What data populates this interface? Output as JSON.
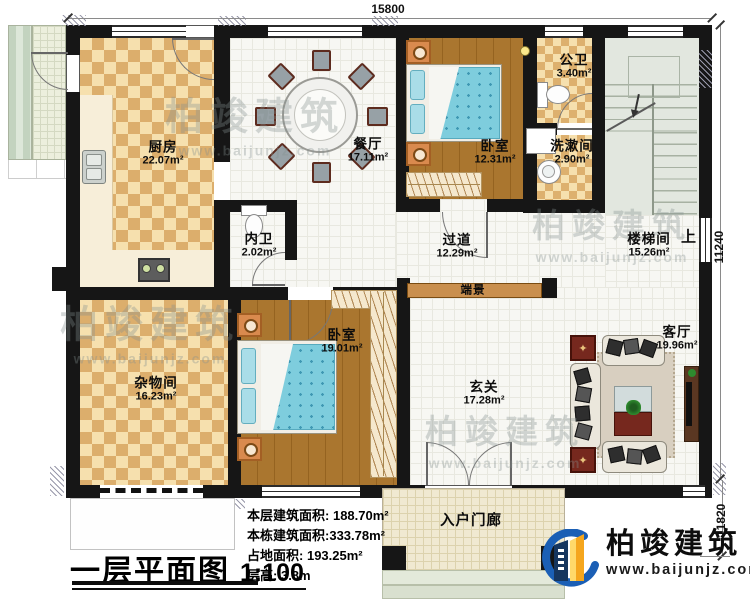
{
  "dimensions": {
    "top": "15800",
    "right_upper": "11240",
    "right_lower": "1820"
  },
  "rooms": {
    "kitchen": {
      "name": "厨房",
      "area": "22.07m²"
    },
    "dining": {
      "name": "餐厅",
      "area": "17.11m²"
    },
    "bedroom_top": {
      "name": "卧室",
      "area": "12.31m²"
    },
    "public_bath": {
      "name": "公卫",
      "area": "3.40m²"
    },
    "washroom": {
      "name": "洗漱间",
      "area": "2.90m²"
    },
    "stairwell": {
      "name": "楼梯间",
      "area": "15.26m²"
    },
    "corridor": {
      "name": "过道",
      "area": "12.29m²"
    },
    "inner_bath": {
      "name": "内卫",
      "area": "2.02m²"
    },
    "bedroom_bottom": {
      "name": "卧室",
      "area": "19.01m²"
    },
    "storage": {
      "name": "杂物间",
      "area": "16.23m²"
    },
    "foyer": {
      "name": "玄关",
      "area": "17.28m²"
    },
    "living": {
      "name": "客厅",
      "area": "19.96m²"
    }
  },
  "labels": {
    "up": "上",
    "console": "端景",
    "entry_porch": "入户门廊"
  },
  "stats": [
    {
      "label": "本层建筑面积:",
      "value": "188.70m²"
    },
    {
      "label": "本栋建筑面积:",
      "value": "333.78m²"
    },
    {
      "label": "占地面积:",
      "value": "193.25m²"
    },
    {
      "label": "层高:",
      "value": "3.8m"
    }
  ],
  "title": {
    "name": "一层平面图",
    "scale": "1:100"
  },
  "brand": {
    "name": "柏竣建筑",
    "url": "www.baijunjz.com"
  },
  "watermark": {
    "text": "柏竣建筑",
    "url": "www.baijunjz.com"
  },
  "colors": {
    "wall": "#161616",
    "wood": "#aa762f",
    "bed": "#7ecddd",
    "brand_blue": "#1b5fb5",
    "brand_orange": "#f5a61d"
  }
}
